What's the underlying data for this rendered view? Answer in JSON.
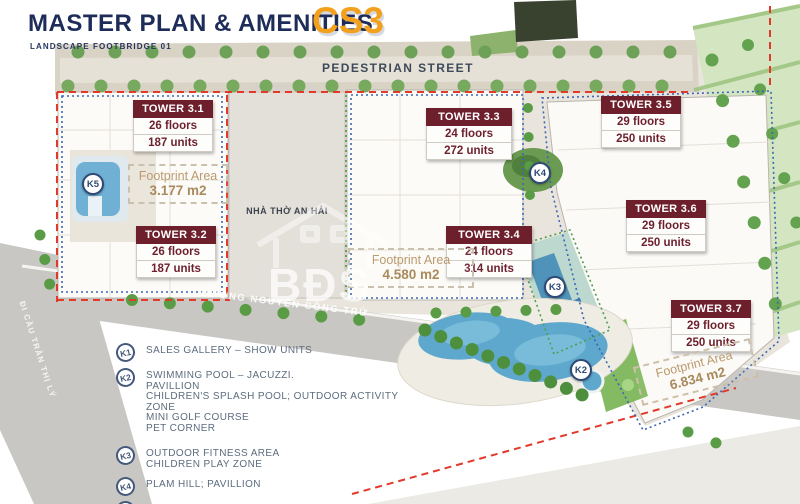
{
  "header": {
    "title": "MASTER PLAN & AMENITIES",
    "project_code": "CS3",
    "subtitle": "LANDSCAPE FOOTBRIDGE 01"
  },
  "map": {
    "street_label": "PEDESTRIAN STREET",
    "parcel_label": "NHÀ THỜ AN HẢI",
    "main_road_label": "ĐƯỜNG NGUYỄN CÔNG TRỨ",
    "side_road_label": "ĐI CẦU TRẦN THỊ LÝ",
    "watermark": "BĐS",
    "markers": [
      {
        "id": "K5"
      },
      {
        "id": "K4"
      },
      {
        "id": "K3"
      },
      {
        "id": "K2"
      }
    ]
  },
  "towers": [
    {
      "name": "TOWER 3.1",
      "floors": "26 floors",
      "units": "187 units"
    },
    {
      "name": "TOWER 3.2",
      "floors": "26 floors",
      "units": "187 units"
    },
    {
      "name": "TOWER 3.3",
      "floors": "24 floors",
      "units": "272 units"
    },
    {
      "name": "TOWER 3.4",
      "floors": "24 floors",
      "units": "314 units"
    },
    {
      "name": "TOWER 3.5",
      "floors": "29 floors",
      "units": "250 units"
    },
    {
      "name": "TOWER 3.6",
      "floors": "29 floors",
      "units": "250 units"
    },
    {
      "name": "TOWER 3.7",
      "floors": "29 floors",
      "units": "250 units"
    }
  ],
  "footprints": [
    {
      "label": "Footprint Area",
      "value": "3.177 m2"
    },
    {
      "label": "Footprint Area",
      "value": "4.580 m2"
    },
    {
      "label": "Footprint Area",
      "value": "6.834 m2"
    }
  ],
  "legend": [
    {
      "key": "K1",
      "lines": [
        "SALES GALLERY – SHOW UNITS"
      ]
    },
    {
      "key": "K2",
      "lines": [
        "SWIMMING POOL – JACUZZI.",
        "PAVILLION",
        "CHILDREN'S SPLASH POOL; OUTDOOR ACTIVITY ZONE",
        "MINI GOLF COURSE",
        "PET CORNER"
      ]
    },
    {
      "key": "K3",
      "lines": [
        "OUTDOOR FITNESS AREA",
        "CHILDREN PLAY ZONE"
      ]
    },
    {
      "key": "K4",
      "lines": [
        "PLAM HILL; PAVILLION"
      ]
    },
    {
      "key": "K5",
      "lines": [
        "LANDSCAPE POOL"
      ]
    }
  ],
  "colors": {
    "navy": "#1e2c5a",
    "orange": "#f3a11c",
    "maroon": "#6d1f2b",
    "pool_blue": "#5fa8cd",
    "boundary_red": "#e2392b",
    "boundary_blue": "#3a68b5"
  }
}
